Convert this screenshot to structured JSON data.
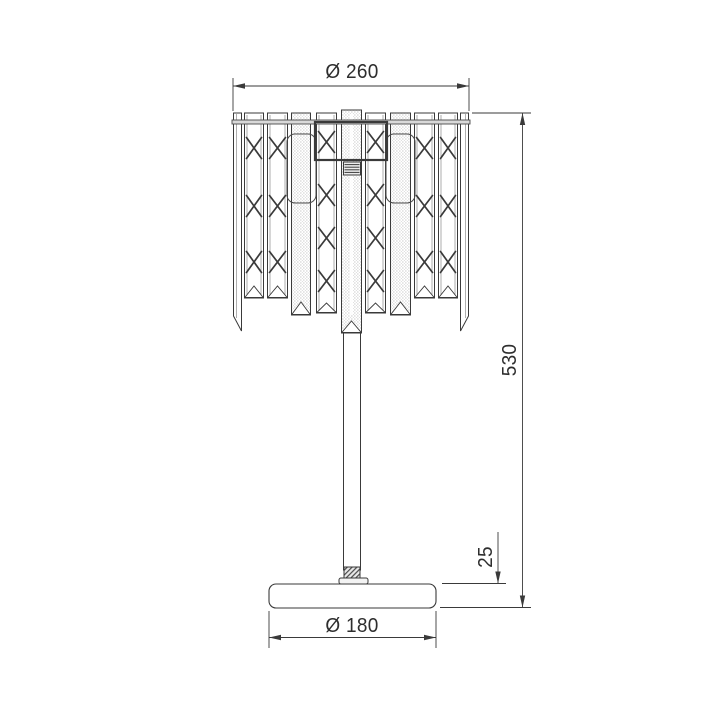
{
  "page": {
    "background": "#ffffff",
    "line_color": "#3a3a3a",
    "light_line_color": "#9a9a9a",
    "text_color": "#2e2e2e"
  },
  "dims": {
    "shade_diameter": {
      "label": "Ø 260",
      "value": 260,
      "ext": [
        {
          "x": 233,
          "y1": 78,
          "y2": 111
        },
        {
          "x": 469,
          "y1": 78,
          "y2": 111
        }
      ],
      "line": {
        "y": 86,
        "x1": 233,
        "x2": 469
      },
      "label_pos": {
        "x": 352,
        "y": 72,
        "rotate": 0
      }
    },
    "total_height": {
      "label": "530",
      "value": 530,
      "ext": [
        {
          "horizontal": true,
          "y": 113,
          "x1": 472,
          "x2": 531
        },
        {
          "horizontal": true,
          "y": 607.5,
          "x1": 440,
          "x2": 531
        }
      ],
      "line": {
        "x": 522.5,
        "y1": 113,
        "y2": 607.5
      },
      "label_pos": {
        "x": 510,
        "y": 360,
        "rotate": -90
      }
    },
    "base_thickness": {
      "label": "25",
      "value": 25,
      "ext": [
        {
          "horizontal": true,
          "y": 583.5,
          "x1": 442,
          "x2": 506
        }
      ],
      "line": {
        "x": 498,
        "y1": 532,
        "y2": 583.5,
        "single_arrow": "down"
      },
      "label_pos": {
        "x": 486,
        "y": 557,
        "rotate": -90
      }
    },
    "base_diameter": {
      "label": "Ø 180",
      "value": 180,
      "ext": [
        {
          "x": 269,
          "y1": 611,
          "y2": 648
        },
        {
          "x": 436,
          "y1": 611,
          "y2": 648
        }
      ],
      "line": {
        "y": 637.5,
        "x1": 269,
        "x2": 436
      },
      "label_pos": {
        "x": 352,
        "y": 626,
        "rotate": 0
      }
    }
  },
  "lamp": {
    "shade": {
      "rim": {
        "x": 232,
        "y": 120,
        "w": 238,
        "h": 4
      },
      "bars": [
        {
          "type": "edge",
          "x": 233,
          "w": 9,
          "top": 113,
          "bottom": 331,
          "cut": 316,
          "side": "left"
        },
        {
          "type": "x",
          "x": 244,
          "w": 20,
          "top": 113,
          "bottom": 298,
          "apex": 286,
          "motifs": [
            148,
            206,
            262
          ]
        },
        {
          "type": "x",
          "x": 267,
          "w": 21,
          "top": 113,
          "bottom": 298,
          "apex": 286,
          "motifs": [
            148,
            206,
            262
          ]
        },
        {
          "type": "stipple",
          "x": 291,
          "w": 20,
          "top": 113,
          "bottom": 315,
          "apex": 302
        },
        {
          "type": "x",
          "x": 316,
          "w": 21,
          "top": 113,
          "bottom": 313,
          "apex": 303,
          "motifs": [
            142,
            195,
            238,
            281
          ]
        },
        {
          "type": "center",
          "x": 341,
          "w": 21,
          "top": 110,
          "bottom": 333,
          "apex": 321
        },
        {
          "type": "x",
          "x": 365,
          "w": 21,
          "top": 113,
          "bottom": 313,
          "apex": 303,
          "motifs": [
            142,
            195,
            238,
            281
          ]
        },
        {
          "type": "stipple",
          "x": 390,
          "w": 21,
          "top": 113,
          "bottom": 315,
          "apex": 302
        },
        {
          "type": "x",
          "x": 414,
          "w": 21,
          "top": 113,
          "bottom": 298,
          "apex": 286,
          "motifs": [
            148,
            206,
            262
          ]
        },
        {
          "type": "x",
          "x": 438,
          "w": 20,
          "top": 113,
          "bottom": 298,
          "apex": 286,
          "motifs": [
            148,
            206,
            262
          ]
        },
        {
          "type": "edge",
          "x": 460,
          "w": 9,
          "top": 113,
          "bottom": 331,
          "cut": 316,
          "side": "right"
        }
      ],
      "housing": {
        "x": 315,
        "y": 122,
        "w": 72,
        "h": 38
      },
      "socket": {
        "x": 343.5,
        "y": 162,
        "w": 17,
        "h": 13,
        "ribs": 4
      },
      "brackets": [
        {
          "x": 287,
          "y": 134,
          "w": 29,
          "h": 69,
          "r": 8
        },
        {
          "x": 386,
          "y": 134,
          "w": 29,
          "h": 69,
          "r": 8
        }
      ]
    },
    "stem": {
      "x": 343.5,
      "w": 17,
      "top": 333,
      "bottom": 570
    },
    "collar": {
      "x": 344,
      "y": 567,
      "w": 16,
      "h": 11
    },
    "flange": {
      "x": 339,
      "y": 578,
      "w": 29,
      "h": 6,
      "r": 2
    },
    "base": {
      "x": 269,
      "y": 584,
      "w": 167,
      "h": 24,
      "r": 7
    }
  }
}
